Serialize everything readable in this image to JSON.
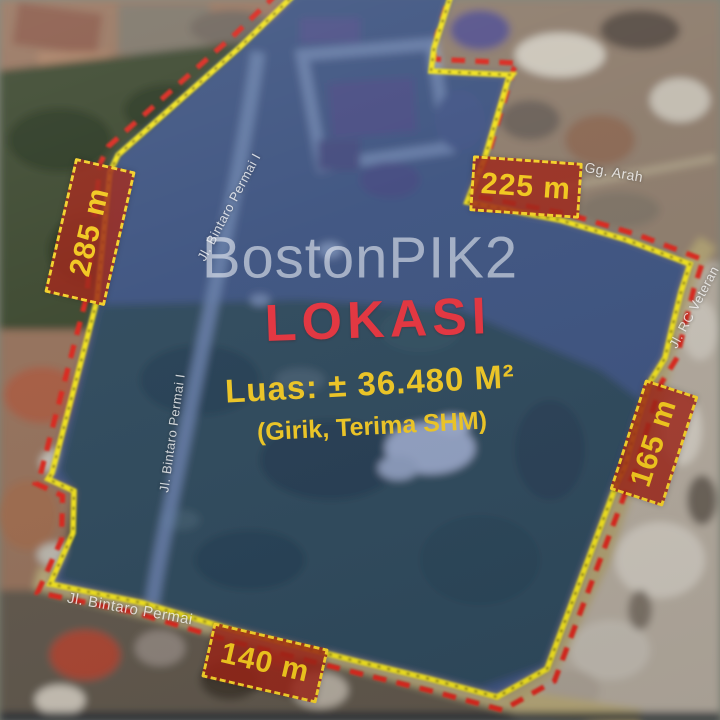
{
  "watermark": {
    "text": "BostonPIK2"
  },
  "headline": {
    "title": "LOKASI",
    "area": "Luas: ± 36.480 M²",
    "tenure": "(Girik, Terima SHM)"
  },
  "measurements": [
    {
      "side": "west",
      "label": "285 m"
    },
    {
      "side": "northeast",
      "label": "225 m"
    },
    {
      "side": "east",
      "label": "165 m"
    },
    {
      "side": "south",
      "label": "140 m"
    }
  ],
  "streets": [
    {
      "id": "bintaro-permai-upper",
      "label": "Jl. Bintaro Permai I"
    },
    {
      "id": "bintaro-permai-left",
      "label": "Jl. Bintaro Permai I"
    },
    {
      "id": "bintaro-permai-bottom",
      "label": "Jl. Bintaro Permai"
    },
    {
      "id": "gg-arah",
      "label": "Gg. Arah"
    },
    {
      "id": "rc-veteran",
      "label": "Jl. RC Veteran"
    }
  ],
  "colors": {
    "boundary_yellow": "#f0e11e",
    "boundary_red_dash": "#d9281d",
    "measure_box_fill": "#9b2316",
    "measure_box_border": "#f3cf27",
    "measure_box_text": "#f1c71c",
    "title_red": "#e4333e",
    "area_yellow": "#eec624",
    "watermark_white": "rgba(238,241,246,0.58)",
    "overlay_blue": "rgba(47,78,158,0.38)"
  }
}
